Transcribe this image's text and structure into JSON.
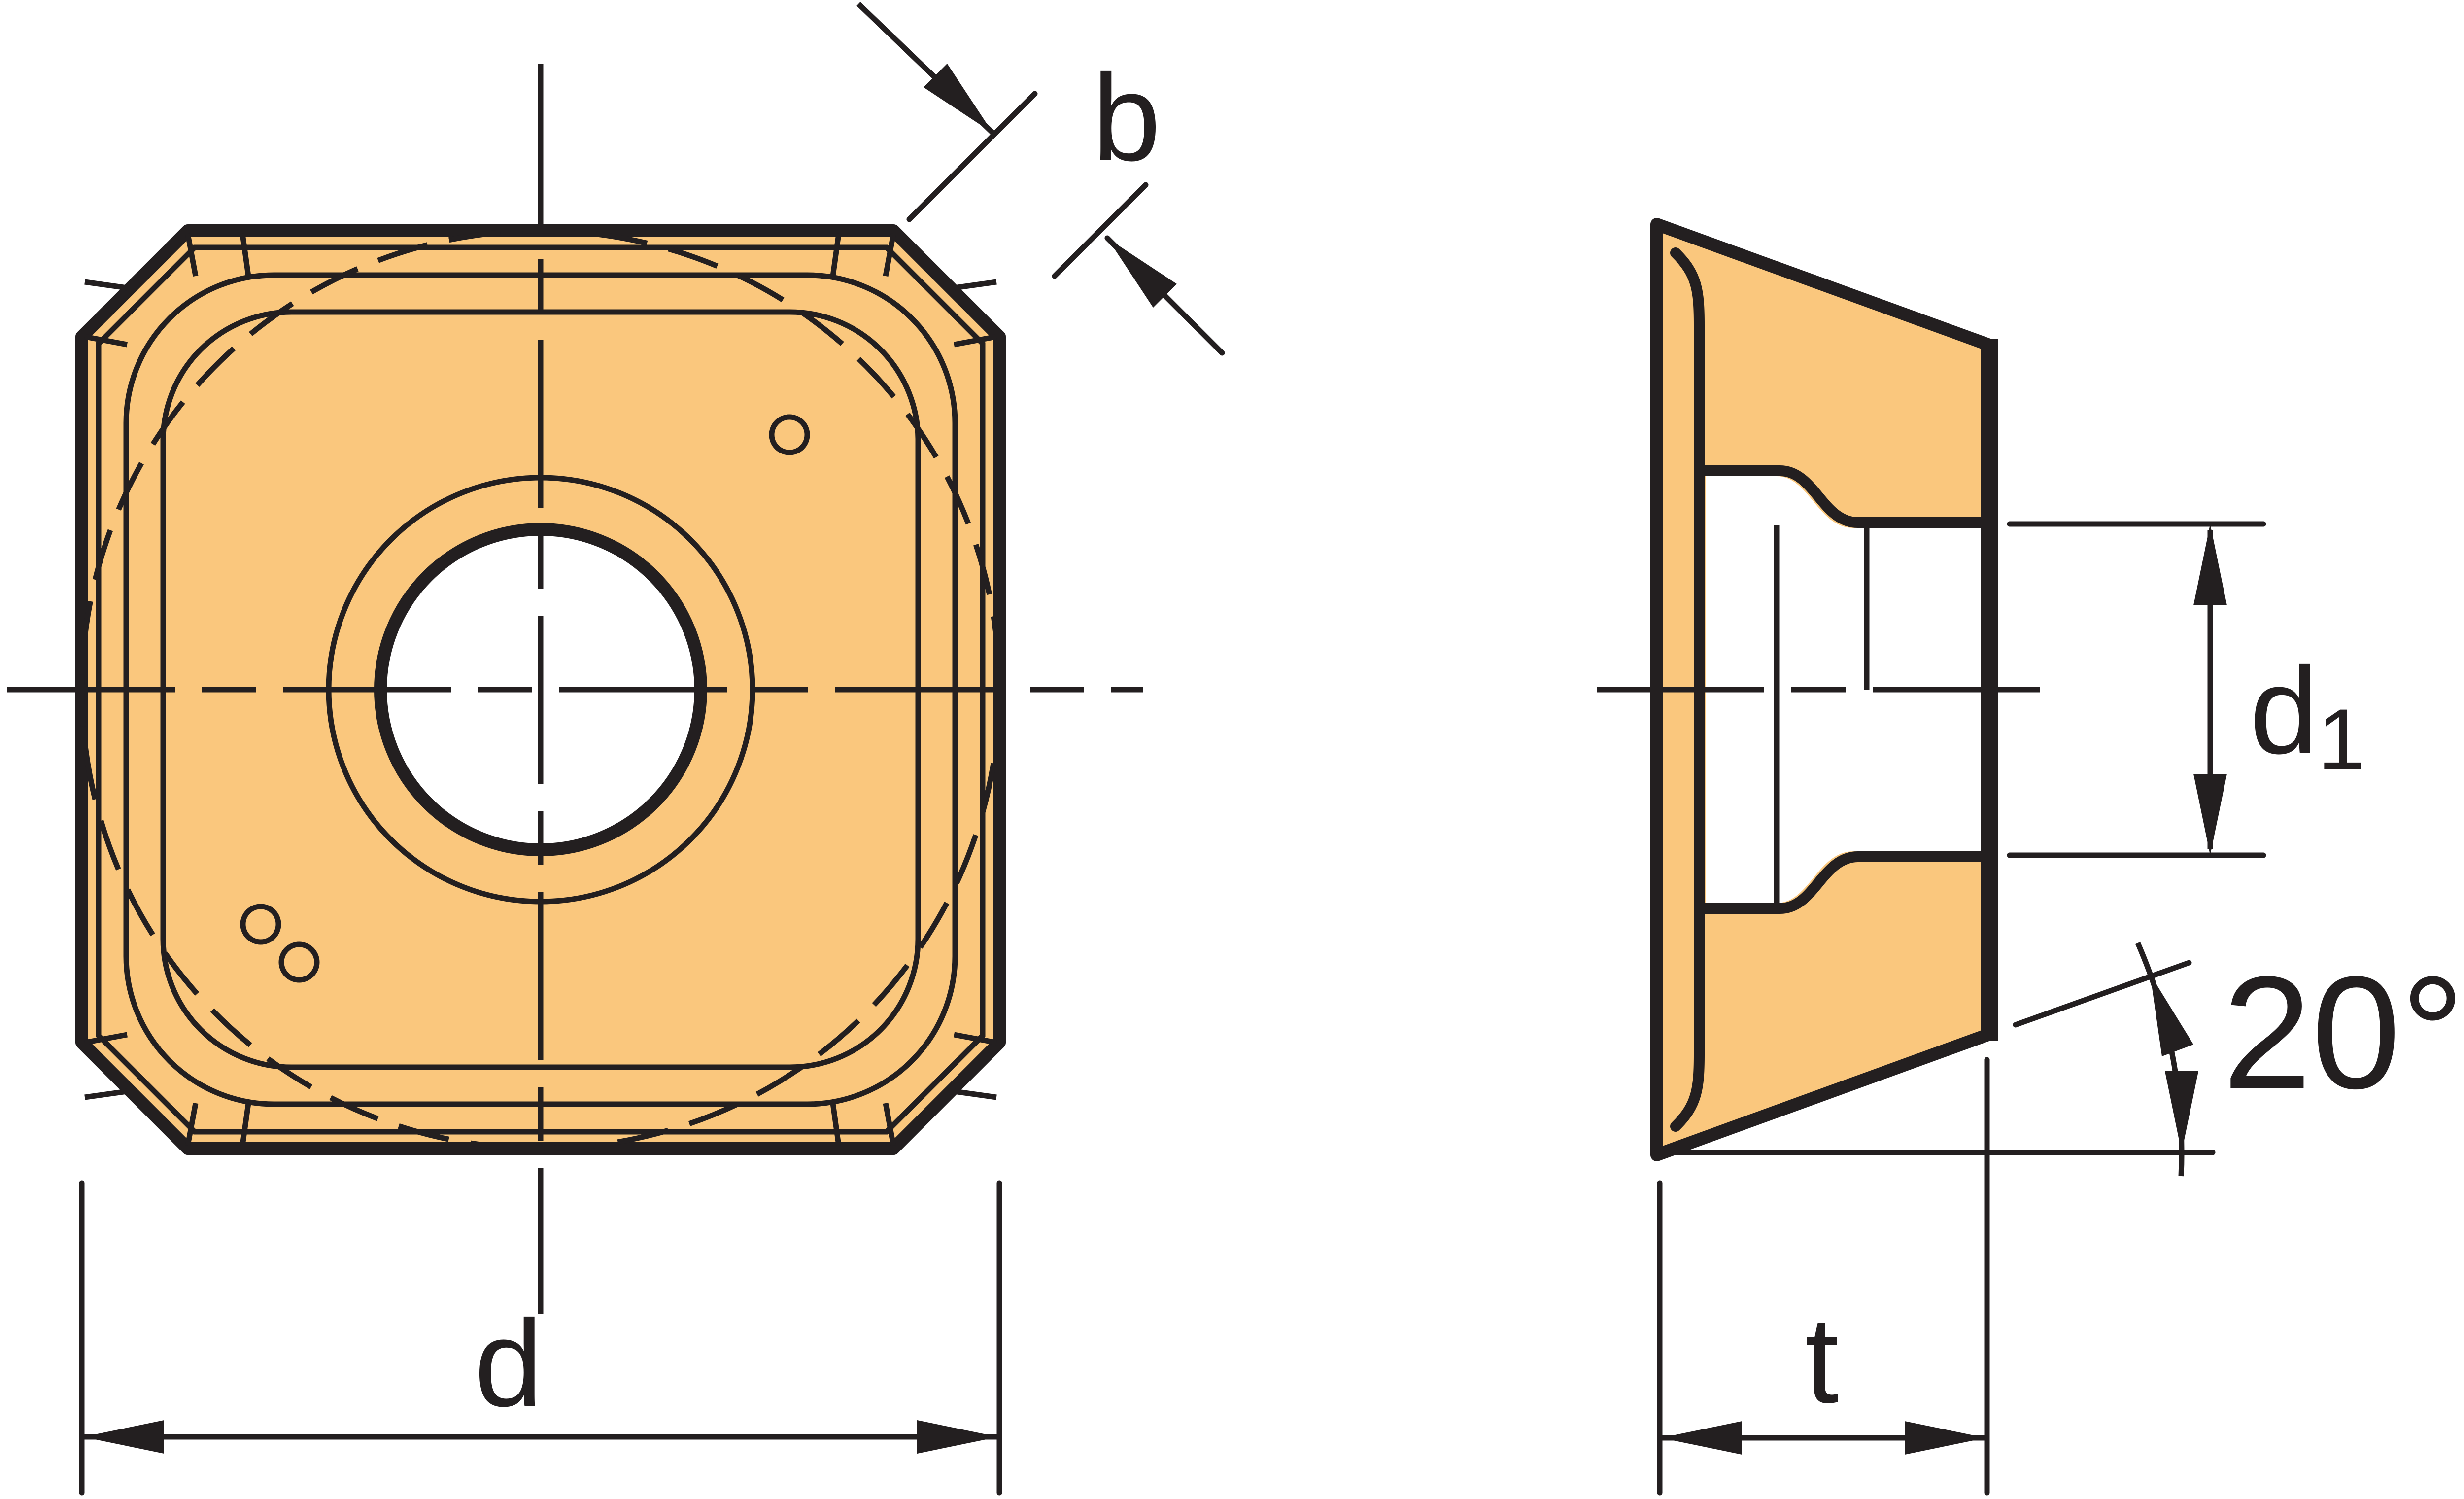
{
  "figure": {
    "type": "technical-drawing",
    "subject": "square indexable milling insert with chamfered corners",
    "views": [
      "top-view",
      "side-view"
    ]
  },
  "labels": {
    "chamfer_width": "b",
    "inscribed_diameter": "d",
    "d1_main": "d",
    "d1_sub": "1",
    "thickness": "t",
    "clearance_angle": "20°"
  },
  "colors": {
    "insert_fill": "#FAC77D",
    "line": "#231F20",
    "background": "#FFFFFF"
  }
}
